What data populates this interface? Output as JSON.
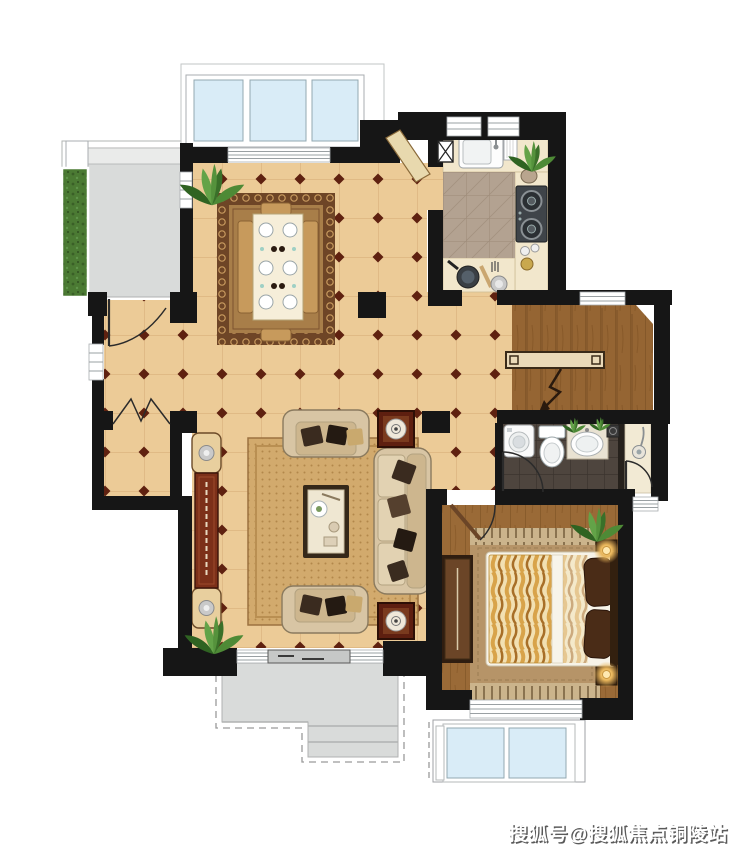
{
  "watermark": {
    "text": "搜狐号@搜狐焦点铜陵站"
  },
  "palette": {
    "wall": "#161616",
    "tile": "#eccb97",
    "tileLine": "#d8b07a",
    "diamond": "#5f2110",
    "wood": "#9a6a38",
    "woodLine": "#7c5226",
    "kitchenFloor": "#b3a291",
    "kitchenLine": "#9c8a77",
    "counter": "#f2e7cc",
    "bathFloor": "#4e453e",
    "bathLine": "#3b342e",
    "shower": "#f2ead4",
    "terrace": "#d9dbda",
    "glass": "#d9ecf7",
    "frameLine": "#a9adb0",
    "rugLiving": "#d2aa6d",
    "rugLivingDot": "#b2874b",
    "rugDiningField": "#a87e49",
    "rugDiningBorder": "#6e4526",
    "sofa": "#d8c5a4",
    "pillow": "#3a2b1f",
    "console": "#7c3019",
    "cream": "#e8cf9e",
    "duvet": "#d8a34a",
    "duvetLight": "#f2e0b2",
    "wardrobe": "#6b4527",
    "plantGreen": "#4b7a33",
    "watermarkFill": "#ffffff",
    "watermarkShadow": "#5a5a5a"
  },
  "icons": [
    "plant-icon",
    "dining-table-icon",
    "dining-chair-icon",
    "sink-icon",
    "dish-rack-icon",
    "stove-icon",
    "wok-icon",
    "flue-icon",
    "kitchen-door-icon",
    "stairs-icon",
    "handrail-icon",
    "down-arrow-icon",
    "washing-machine-icon",
    "toilet-icon",
    "vanity-sink-icon",
    "floor-drain-icon",
    "shower-head-icon",
    "door-swing-icon",
    "folding-door-icon",
    "sliding-door-icon",
    "window-icon",
    "bed-icon",
    "pillow-icon",
    "wardrobe-icon",
    "nightstand-lamp-icon",
    "bedside-rug-icon",
    "sofa-icon",
    "loveseat-icon",
    "coffee-table-icon",
    "tv-console-icon",
    "end-table-icon",
    "planter-icon",
    "terrace-icon",
    "steps-icon"
  ]
}
